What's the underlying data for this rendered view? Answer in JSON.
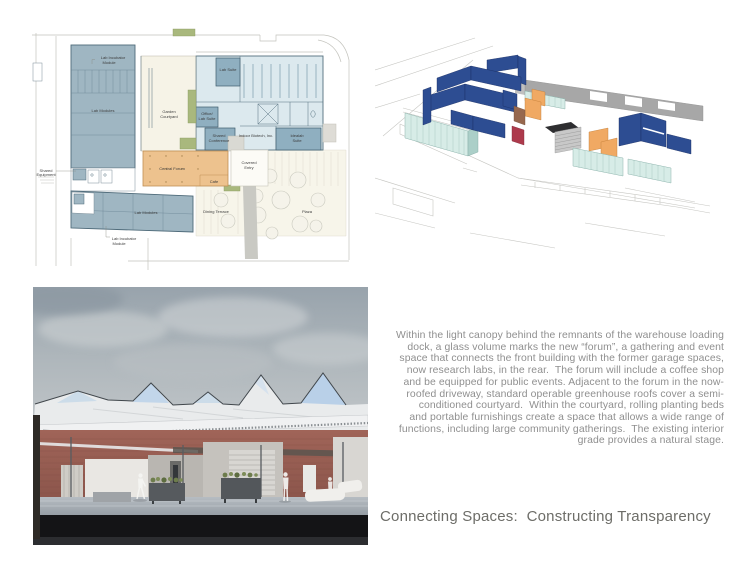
{
  "board": {
    "title": "Connecting Spaces:  Constructing Transparency",
    "description": "Within the light canopy behind the remnants of the warehouse loading\ndock, a glass volume marks the new “forum”, a gathering and event\nspace that connects the front building with the former garage spaces,\nnow research labs, in the rear.  The forum will include a coffee shop\nand be equipped for public events. Adjacent to the forum in the now-\nroofed driveway, standard operable greenhouse roofs cover a semi-\nconditioned courtyard.  Within the courtyard, rolling planting beds\nand portable furnishings create a space that allows a wide range of\nfunctions, including large community gatherings.  The existing interior\ngrade provides a natural stage."
  },
  "floor_plan": {
    "labels": {
      "shared_equipment_1": "Shared",
      "shared_equipment_2": "Equipment",
      "lab_incubator_top_1": "Lab Incubator",
      "lab_incubator_top_2": "Module",
      "lab_modules_left": "Lab Modules",
      "garden_1": "Garden",
      "garden_2": "Courtyard",
      "lab_suite": "Lab Suite",
      "office_lab_1": "Office/",
      "office_lab_2": "Lab Suite",
      "shared_conference_1": "Shared",
      "shared_conference_2": "Conference",
      "indoor_biotech": "Indoor Biotech, Inc.",
      "idealab_1": "Idealab",
      "idealab_2": "Suite",
      "central_forum": "Central Forum",
      "covered_entry_1": "Covered",
      "covered_entry_2": "Entry",
      "cafe": "Cafe",
      "dining_terrace": "Dining Terrace",
      "plaza": "Plaza",
      "lab_modules_bottom": "Lab Modules",
      "lab_incubator_bottom_1": "Lab Incubator",
      "lab_incubator_bottom_2": "Module"
    }
  },
  "colors": {
    "plan_room_blue": "#9fb6c2",
    "plan_field_blue": "#dce9ee",
    "plan_forum_orange": "#edc28e",
    "plan_green": "#a9b87d",
    "axon_wall_blue": "#2d4d92",
    "axon_orange": "#f0a963",
    "axon_red": "#ad3a4c",
    "axon_glass_teal": "#d7ece7",
    "axon_roof_gray": "#a7a7a7",
    "render_sky_gray": "#a9b1b8",
    "render_brick": "#9c6155",
    "render_glass_blue": "#c6daec",
    "text_gray": "#8f8f8f",
    "title_gray": "#6d6d68"
  }
}
